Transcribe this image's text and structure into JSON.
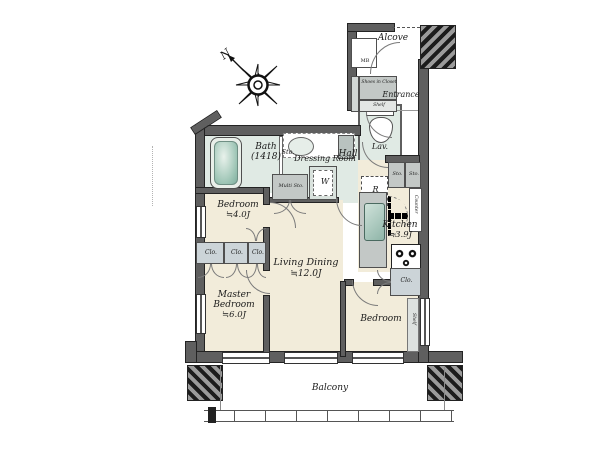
{
  "labels": {
    "alcove": "Alcove",
    "mb": "MB",
    "entrance": "Entrance",
    "shoes_closet": "Shoes in Closet",
    "shoes_shelf": "Shelf",
    "lav": "Lav.",
    "hall": "Hall",
    "bath_name": "Bath",
    "bath_size": "(1418)",
    "sto": "Sto.",
    "dressing_room": "Dressing Room",
    "multi_sto": "Multi Sto.",
    "washer": "W",
    "fridge": "R",
    "sto_a": "Sto.",
    "sto_b": "Sto.",
    "counter": "Counter",
    "kitchen_name": "Kitchen",
    "kitchen_size": "≒3.9J",
    "bedroom_small_name": "Bedroom",
    "bedroom_small_size": "≒4.0J",
    "clo_1": "Clo.",
    "clo_2": "Clo.",
    "clo_3": "Clo.",
    "master_name": "Master Bedroom",
    "master_size": "≒6.0J",
    "living_name": "Living Dining",
    "living_size": "≒12.0J",
    "bedroom_right": "Bedroom",
    "clo_right": "Clo.",
    "shelf_right": "Shelf",
    "balcony": "Balcony",
    "compass_north": "N"
  },
  "colors": {
    "wall": "#5f5f5f",
    "floor": "#f2ecda",
    "wet": "#e0eae4",
    "closet": "#ccd4d8",
    "storage": "#c3c8c6"
  }
}
